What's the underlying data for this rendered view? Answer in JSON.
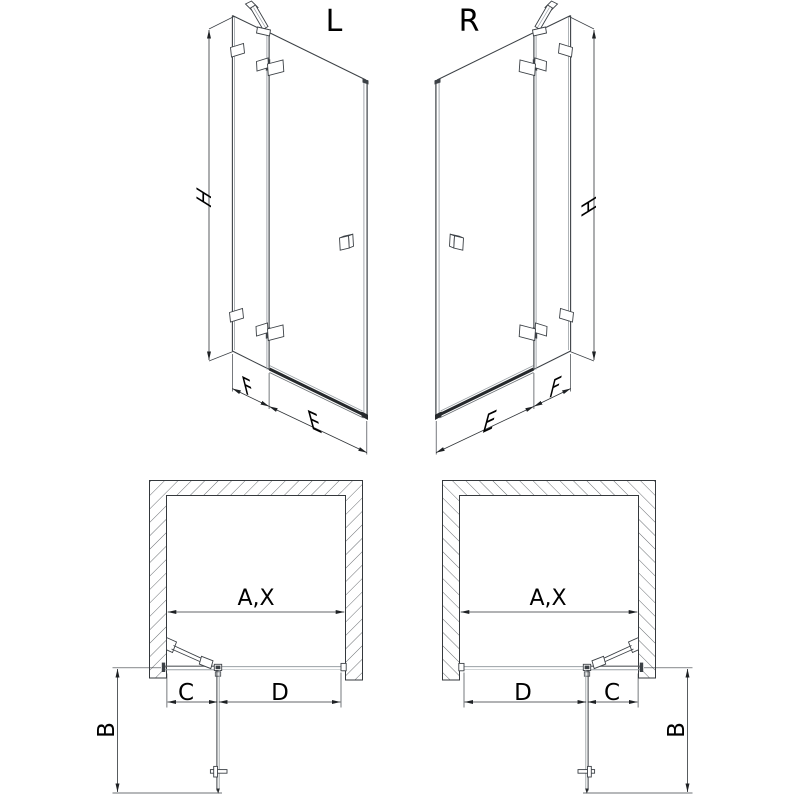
{
  "document": {
    "type": "shower-door-technical-drawing",
    "background_color": "#ffffff",
    "line_color": "#3c4146",
    "views": [
      "elevation-left",
      "elevation-right",
      "plan-left",
      "plan-right"
    ]
  },
  "views": {
    "elevation_left": {
      "variant_label": "L",
      "height_label": "H",
      "fixed_panel_label": "F",
      "door_label": "E"
    },
    "elevation_right": {
      "variant_label": "R",
      "height_label": "H",
      "fixed_panel_label": "F",
      "door_label": "E"
    },
    "plan_left": {
      "opening_label": "A,X",
      "depth_label": "B",
      "fixed_segment_label": "C",
      "door_segment_label": "D"
    },
    "plan_right": {
      "opening_label": "A,X",
      "depth_label": "B",
      "fixed_segment_label": "C",
      "door_segment_label": "D"
    }
  }
}
